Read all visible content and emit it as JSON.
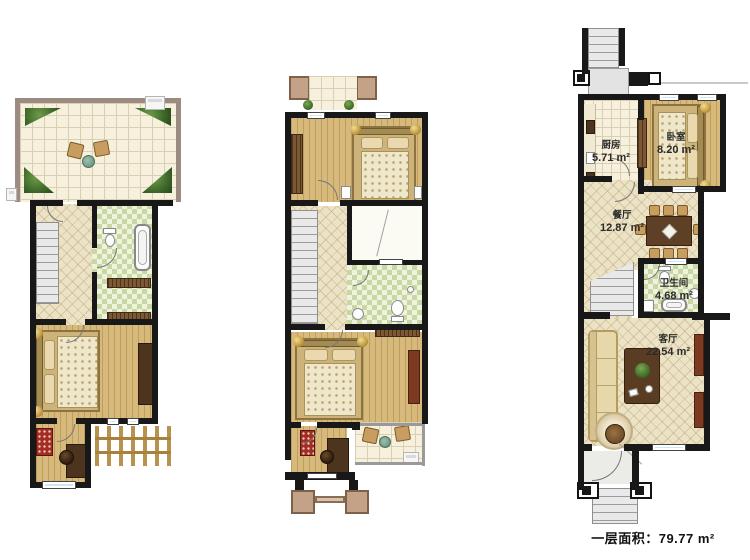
{
  "floorplan": {
    "caption": "一层面积：79.77 m²",
    "rooms": {
      "kitchen": {
        "name": "厨房",
        "area": "5.71 m²"
      },
      "bedroom": {
        "name": "卧室",
        "area": "8.20 m²"
      },
      "dining": {
        "name": "餐厅",
        "area": "12.87 m²"
      },
      "bathroom": {
        "name": "卫生间",
        "area": "4.68 m²"
      },
      "living": {
        "name": "客厅",
        "area": "22.54 m²"
      }
    }
  },
  "colors": {
    "wall": "#181818",
    "wood_floor": "#d7b97c",
    "tile_floor": "#f6f0dc",
    "diamond_floor": "#ece2c5",
    "bath_tile": "#c8d8a4",
    "window": "#cfe7f1",
    "plant": "#3a6428",
    "stairs": "#e9e9e9",
    "accent_red": "#a32c26",
    "label_text": "#2a2a2a"
  }
}
